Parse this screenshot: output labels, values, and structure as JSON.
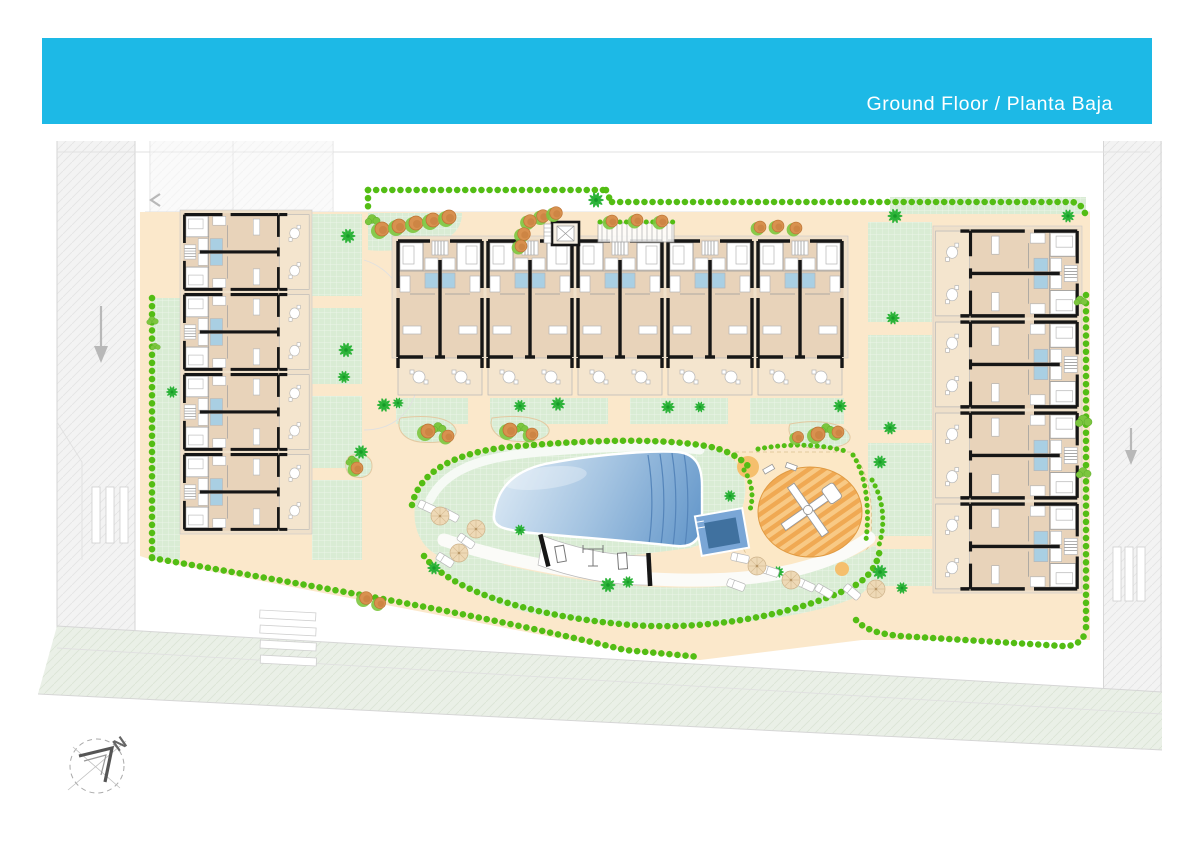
{
  "header": {
    "title": "Ground Floor / Planta Baja"
  },
  "compass": {
    "label": "N"
  },
  "colors": {
    "banner": "#1db9e6",
    "title": "#ffffff",
    "wall": "#161616",
    "floor": "#e8d3ba",
    "floor_light": "#efe0ca",
    "terrace": "#f4e5ce",
    "room": "#ffffff",
    "bath": "#a9cfe3",
    "path": "#fbe8cb",
    "path_deep": "#f6dab4",
    "lawn": "#d9ecd4",
    "hedge": "#53bd14",
    "palm": "#2cb339",
    "palm_dark": "#179b28",
    "tree_orange": "#d8914f",
    "tree_orange_dark": "#bd7435",
    "pool_g1": "#e3eef7",
    "pool_g2": "#a3c3e1",
    "pool_g3": "#5e93c8",
    "kids_pool": "#7aa6d6",
    "kids_pool_dark": "#40719f",
    "play_sand": "#fce8c6",
    "play_stripe1": "#f8c985",
    "play_stripe2": "#f0a953",
    "sand_circle": "#f5bf6d",
    "parasol": "#eed9b6",
    "road": "#f3f3f3",
    "road_green": "#eaf0e7",
    "road_line": "#d6d6d6",
    "gray": "#9a9a9a"
  },
  "site": {
    "buildings": {
      "left": {
        "units": 4,
        "transforms": [
          "translate(182,292) scale(0.81,0.89) rotate(-90)",
          "translate(182,372) scale(0.81,0.89) rotate(-90)",
          "translate(182,452) scale(0.81,0.89) rotate(-90)",
          "translate(182,532) scale(0.81,0.89) rotate(-90)"
        ]
      },
      "center": {
        "units": 5,
        "transforms": [
          "translate(395,238)",
          "translate(485,238)",
          "translate(575,238)",
          "translate(665,238)",
          "translate(755,238)"
        ]
      },
      "right": {
        "units": 4,
        "transforms": [
          "translate(1080,228) scale(0.92,1.01) rotate(90)",
          "translate(1080,319) scale(0.92,1.01) rotate(90)",
          "translate(1080,410) scale(0.92,1.01) rotate(90)",
          "translate(1080,501) scale(0.92,1.01) rotate(90)"
        ]
      }
    },
    "decor": {
      "palms": [
        [
          348,
          236,
          1
        ],
        [
          346,
          350,
          1
        ],
        [
          344,
          377,
          0.85
        ],
        [
          361,
          452,
          0.95
        ],
        [
          172,
          392,
          0.8
        ],
        [
          596,
          200,
          1.05
        ],
        [
          384,
          405,
          0.95
        ],
        [
          398,
          403,
          0.75
        ],
        [
          520,
          406,
          0.85
        ],
        [
          558,
          404,
          0.95
        ],
        [
          668,
          407,
          0.9
        ],
        [
          700,
          407,
          0.75
        ],
        [
          840,
          406,
          0.9
        ],
        [
          895,
          216,
          1
        ],
        [
          893,
          318,
          0.9
        ],
        [
          890,
          428,
          0.9
        ],
        [
          880,
          462,
          0.9
        ],
        [
          880,
          572,
          1
        ],
        [
          902,
          588,
          0.8
        ],
        [
          434,
          568,
          0.9
        ],
        [
          520,
          530,
          0.75
        ],
        [
          608,
          585,
          1
        ],
        [
          628,
          582,
          0.8
        ],
        [
          778,
          572,
          0.8
        ],
        [
          730,
          496,
          0.8
        ],
        [
          1068,
          216,
          0.9
        ]
      ],
      "orange_trees": [
        [
          382,
          229,
          1
        ],
        [
          399,
          226,
          1
        ],
        [
          416,
          223,
          1
        ],
        [
          433,
          220,
          1
        ],
        [
          449,
          217,
          1
        ],
        [
          543,
          216,
          0.9
        ],
        [
          556,
          213,
          0.9
        ],
        [
          530,
          221,
          0.9
        ],
        [
          524,
          234,
          0.9
        ],
        [
          521,
          246,
          0.85
        ],
        [
          612,
          221,
          0.85
        ],
        [
          637,
          220,
          0.85
        ],
        [
          662,
          221,
          0.85
        ],
        [
          760,
          227,
          0.85
        ],
        [
          778,
          226,
          0.85
        ],
        [
          796,
          228,
          0.85
        ],
        [
          428,
          431,
          1
        ],
        [
          448,
          436,
          0.85
        ],
        [
          510,
          430,
          1
        ],
        [
          532,
          434,
          0.85
        ],
        [
          818,
          434,
          1
        ],
        [
          838,
          432,
          0.85
        ],
        [
          798,
          437,
          0.8
        ],
        [
          357,
          468,
          0.85
        ],
        [
          366,
          598,
          0.9
        ],
        [
          380,
          603,
          0.8
        ]
      ],
      "shrubs": [
        [
          438,
          427,
          0.9
        ],
        [
          521,
          427,
          0.8
        ],
        [
          826,
          428,
          0.9
        ],
        [
          352,
          460,
          0.8
        ],
        [
          372,
          219,
          0.9
        ],
        [
          1083,
          420,
          1
        ],
        [
          1083,
          472,
          0.9
        ],
        [
          152,
          320,
          0.7
        ],
        [
          155,
          346,
          0.6
        ],
        [
          1080,
          300,
          0.8
        ]
      ],
      "parasols": [
        [
          440,
          516
        ],
        [
          476,
          529
        ],
        [
          459,
          553
        ],
        [
          757,
          566
        ],
        [
          791,
          580
        ],
        [
          876,
          589
        ]
      ],
      "loungers": [
        [
          427,
          507,
          -65
        ],
        [
          450,
          515,
          -62
        ],
        [
          466,
          541,
          -55
        ],
        [
          445,
          560,
          -58
        ],
        [
          740,
          558,
          -78
        ],
        [
          770,
          571,
          -72
        ],
        [
          806,
          585,
          -65
        ],
        [
          824,
          591,
          -60
        ],
        [
          852,
          592,
          -50
        ],
        [
          736,
          585,
          -70
        ]
      ]
    }
  }
}
